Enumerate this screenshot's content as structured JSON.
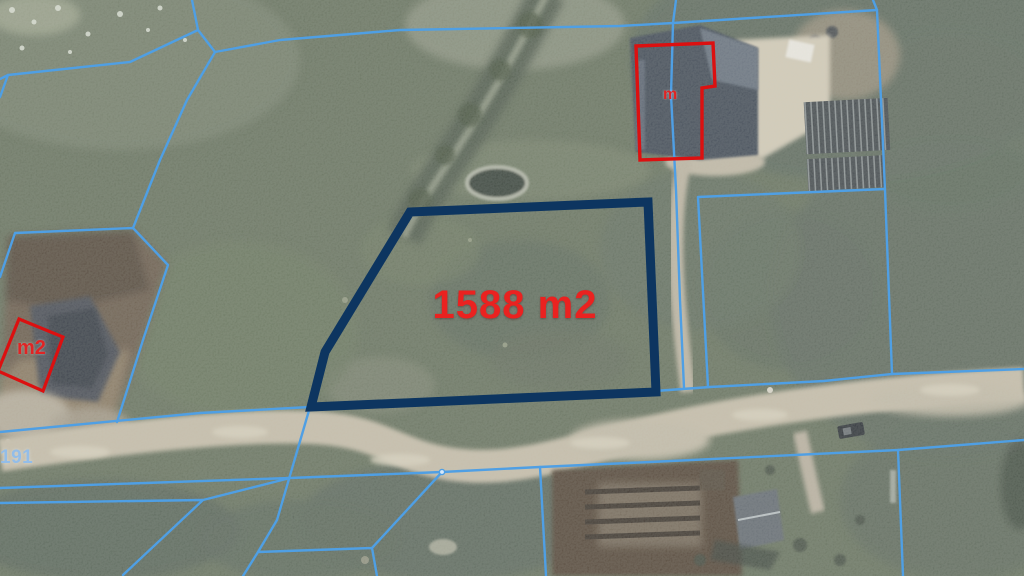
{
  "map": {
    "kind": "aerial-cadastral-map",
    "parcel": {
      "area_label": "1588 m2"
    },
    "annotations": {
      "right_building_label": "m",
      "left_building_label": "m2",
      "road_number": "191"
    },
    "colors": {
      "parcel_outline": "#0d3560",
      "boundary_line": "#4f9fe4",
      "building_outline": "#dc1010",
      "area_label_text": "#ea2220",
      "road_number_text": "#93bde8"
    }
  }
}
